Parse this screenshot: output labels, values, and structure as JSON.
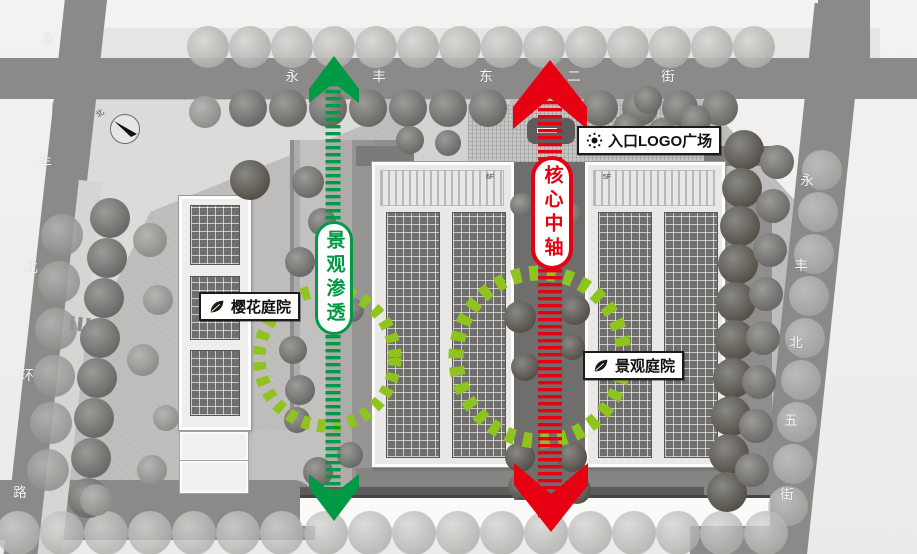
{
  "colors": {
    "axis_green": "#009944",
    "circle_green": "#8fc31f",
    "axis_red": "#e60012",
    "road_gray": "#8b8a88"
  },
  "streets": {
    "top": {
      "name": "永丰东二街",
      "chars": [
        "永",
        "丰",
        "东",
        "二",
        "街"
      ]
    },
    "left": {
      "name": "永丰北环路",
      "chars": [
        "永",
        "丰",
        "北",
        "环",
        "路"
      ]
    },
    "right": {
      "name": "永丰北五街",
      "chars": [
        "永",
        "丰",
        "北",
        "五",
        "街"
      ]
    }
  },
  "annotations": {
    "green_axis": {
      "label": "景观渗透"
    },
    "core_axis": {
      "label": "核心中轴"
    },
    "entrance_plaza": {
      "label": "入口LOGO广场"
    },
    "sakura_courtyard": {
      "label": "樱花庭院"
    },
    "landscape_courtyard": {
      "label": "景观庭院"
    }
  },
  "buildings": {
    "middle_tag": "6F",
    "right_tag": "5F"
  },
  "compass": {
    "north": "北"
  }
}
